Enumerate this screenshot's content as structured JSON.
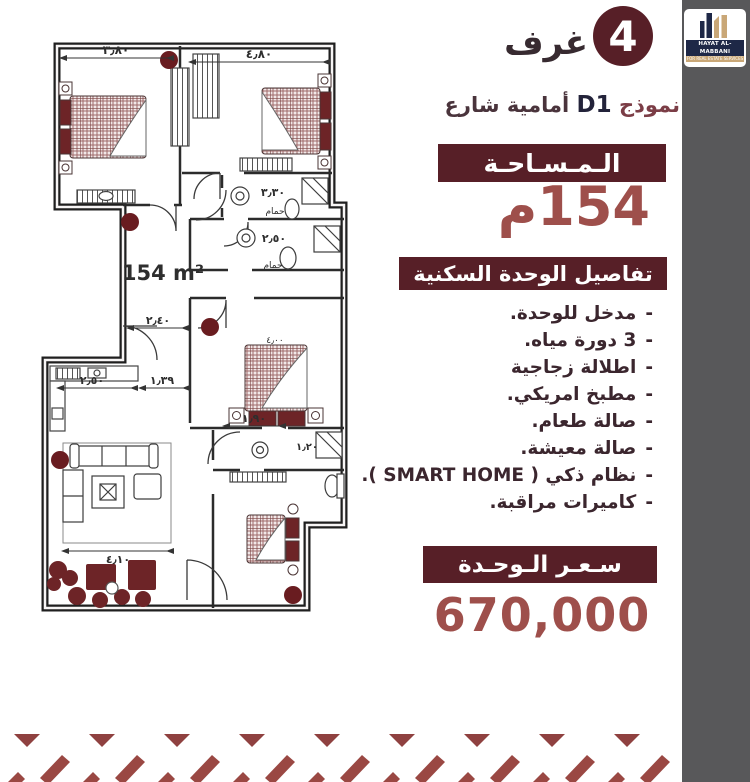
{
  "colors": {
    "accent_dark": "#571f27",
    "accent_red": "#9e4f4b",
    "text_dark": "#3b262e",
    "strip_gray": "#58585a",
    "logo_navy": "#1e2847",
    "logo_gold": "#c9a777",
    "plan_maroon": "#6d2427",
    "pattern_red": "#8f4140"
  },
  "logo": {
    "name": "HAYAT AL-MABBANI",
    "tagline": "FOR REAL ESTATE SERVICES"
  },
  "header": {
    "rooms_count": "4",
    "rooms_label": "غرف",
    "model_word": "نموذج",
    "model_code": "D1",
    "model_suffix": "أمامية شارع"
  },
  "area": {
    "banner": "الـمـسـاحـة",
    "value": "154م"
  },
  "details": {
    "banner": "تفاصيل الوحدة السكنية",
    "bullet": "-",
    "items": [
      "مدخل للوحدة.",
      "3 دورة مياه.",
      "اطلالة زجاجية",
      "مطبخ امريكي.",
      "صالة طعام.",
      "صالة معيشة.",
      "نظام ذكي ( SMART HOME ).",
      "كاميرات مراقبة."
    ]
  },
  "price": {
    "banner": "سـعـر الـوحـدة",
    "value": "670,000"
  },
  "plan": {
    "area_label": "154 m²",
    "bath1_label": "حمام",
    "bath2_label": "حمام",
    "dims": {
      "d380": "٣٫٨٠",
      "d480": "٤٫٨٠",
      "d330": "٣٫٣٠",
      "d250a": "٢٫٥٠",
      "d240": "٢٫٤٠",
      "d250b": "٢٫٥٠",
      "d139": "١٫٣٩",
      "d190": "١٫٩٠",
      "d120": "١٫٢٠",
      "d410": "٤٫١٠",
      "d400": "٤٫٠٠"
    }
  }
}
